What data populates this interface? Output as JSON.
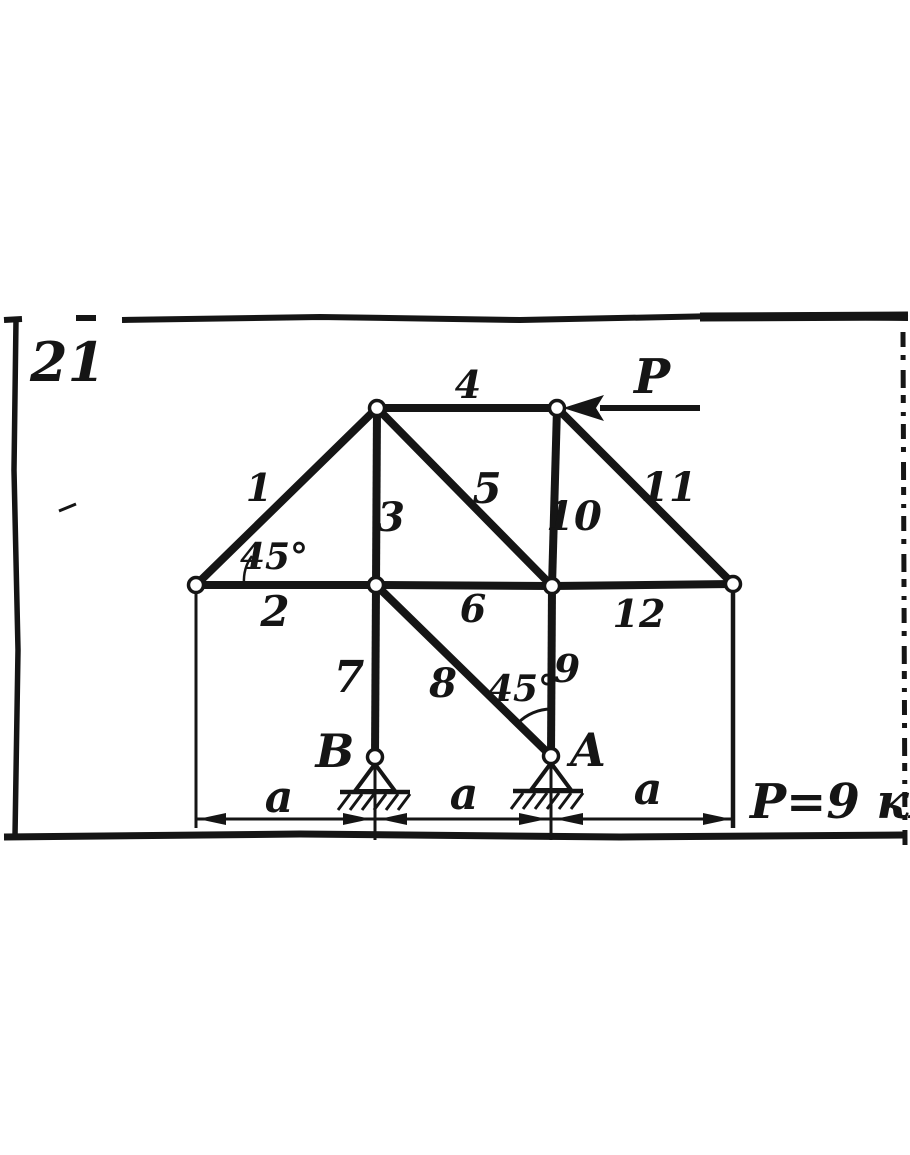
{
  "figure": {
    "number": "21"
  },
  "force": {
    "label": "P",
    "equation": "P=9 кН"
  },
  "members": {
    "1": "1",
    "2": "2",
    "3": "3",
    "4": "4",
    "5": "5",
    "6": "6",
    "7": "7",
    "8": "8",
    "9": "9",
    "10": "10",
    "11": "11",
    "12": "12"
  },
  "angles": {
    "left": "45°",
    "a": "45°"
  },
  "supports": {
    "b": "B",
    "a": "A"
  },
  "dims": {
    "left": "a",
    "mid": "a",
    "right": "a"
  },
  "colors": {
    "ink": "#151515",
    "paper": "#ffffff"
  }
}
